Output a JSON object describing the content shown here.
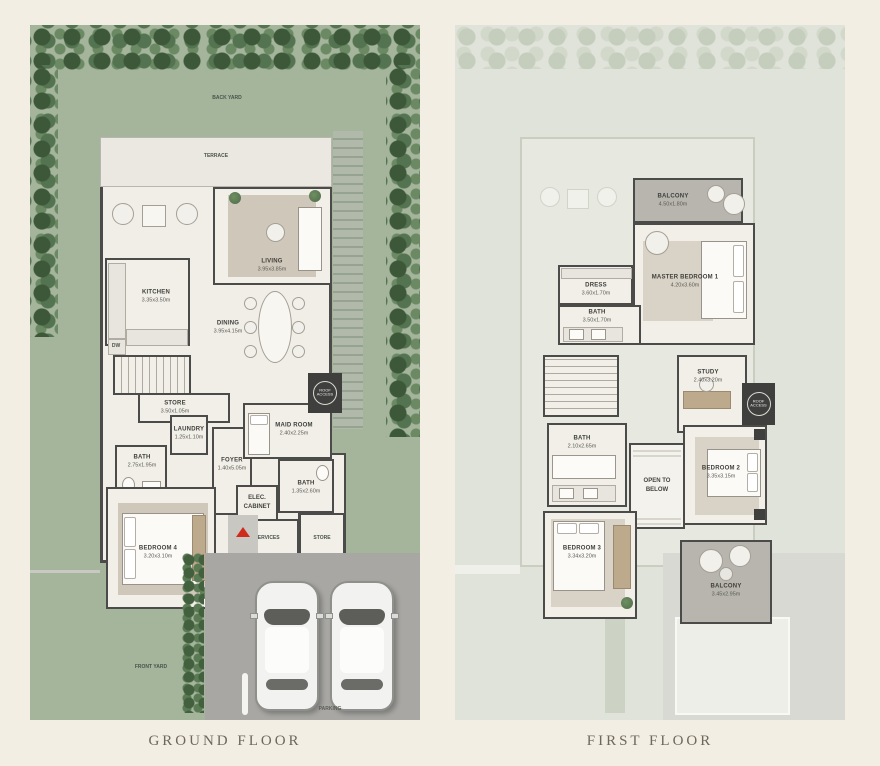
{
  "titles": {
    "ground": "GROUND FLOOR",
    "first": "FIRST FLOOR"
  },
  "colors": {
    "page_bg": "#f2eee3",
    "lawn": "#a4b59c",
    "shrub_dark": "#3c5839",
    "wall": "#4b4b49",
    "room_floor": "#f1efe8",
    "balcony_floor": "#b7b5ae",
    "driveway": "#a8a7a4",
    "entry_arrow_red": "#cf2a1d",
    "title_text": "#6e675c",
    "first_floor_bg": "#dfe3da"
  },
  "ground_floor": {
    "labels": {
      "back_yard": "BACK YARD",
      "terrace": "TERRACE",
      "front_yard": "FRONT YARD",
      "parking": "PARKING",
      "dw": "DW",
      "roof_access": "ROOF ACCESS",
      "services": "SERVICES",
      "store_small": "STORE",
      "elec_cabinet": "ELEC. CABINET"
    },
    "rooms": {
      "living": {
        "name": "LIVING",
        "dims": "3.95x3.85m"
      },
      "kitchen": {
        "name": "KITCHEN",
        "dims": "3.35x3.50m"
      },
      "dining": {
        "name": "DINING",
        "dims": "3.95x4.15m"
      },
      "store": {
        "name": "STORE",
        "dims": "3.50x1.05m"
      },
      "laundry": {
        "name": "LAUNDRY",
        "dims": "1.25x1.10m"
      },
      "bath": {
        "name": "BATH",
        "dims": "2.75x1.95m"
      },
      "foyer": {
        "name": "FOYER",
        "dims": "1.40x5.05m"
      },
      "maid_room": {
        "name": "MAID ROOM",
        "dims": "2.40x2.25m"
      },
      "bath_guest": {
        "name": "BATH",
        "dims": "1.35x2.60m"
      },
      "bedroom4": {
        "name": "BEDROOM 4",
        "dims": "3.20x3.10m"
      }
    }
  },
  "first_floor": {
    "labels": {
      "roof_access": "ROOF ACCESS",
      "open_to_below": "OPEN TO BELOW"
    },
    "rooms": {
      "balcony_front": {
        "name": "BALCONY",
        "dims": "4.50x1.80m"
      },
      "master_bedroom": {
        "name": "MASTER BEDROOM 1",
        "dims": "4.20x3.60m"
      },
      "dress": {
        "name": "DRESS",
        "dims": "3.60x1.70m"
      },
      "bath_master": {
        "name": "BATH",
        "dims": "3.50x1.70m"
      },
      "study": {
        "name": "STUDY",
        "dims": "2.40x3.20m"
      },
      "bath_shared": {
        "name": "BATH",
        "dims": "2.10x2.65m"
      },
      "bedroom2": {
        "name": "BEDROOM 2",
        "dims": "3.35x3.15m"
      },
      "bedroom3": {
        "name": "BEDROOM 3",
        "dims": "3.34x3.20m"
      },
      "balcony_rear": {
        "name": "BALCONY",
        "dims": "3.45x2.95m"
      }
    }
  }
}
